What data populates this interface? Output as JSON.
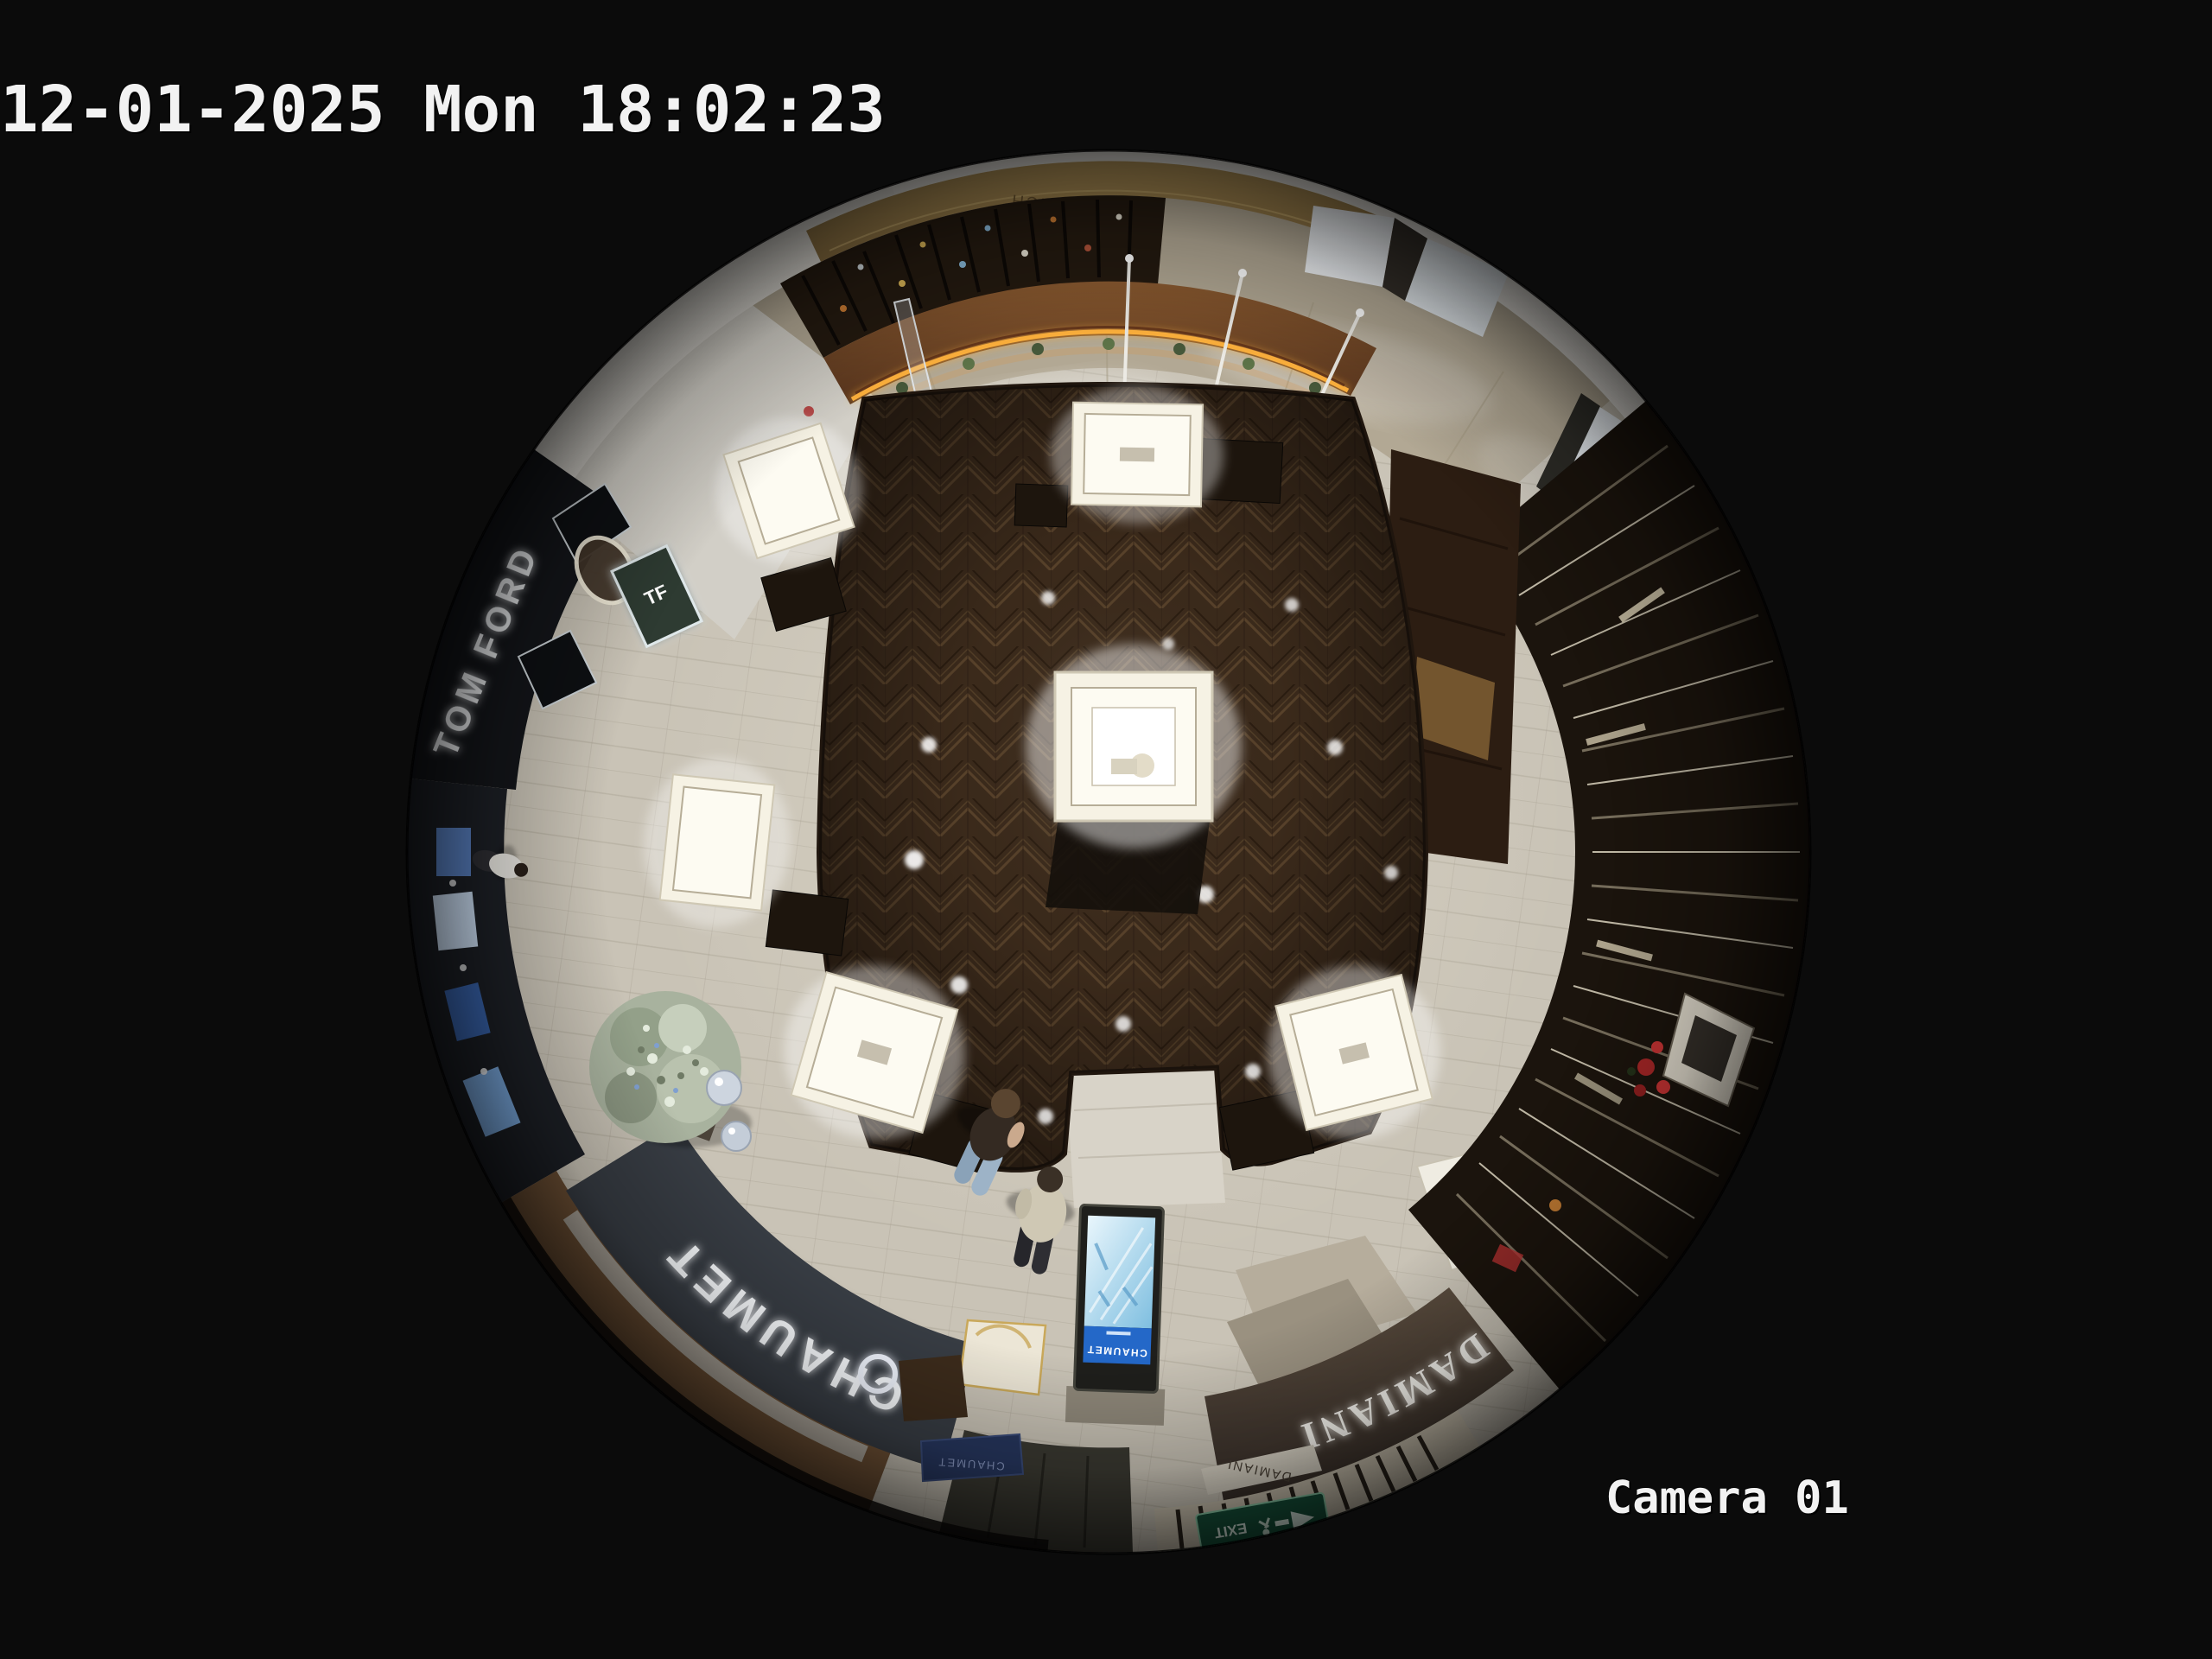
{
  "osd": {
    "timestamp": "12-01-2025 Mon 18:02:23",
    "camera_label": "Camera 01"
  },
  "signs": {
    "tom_ford": "TOM FORD",
    "tf_monogram": "TF",
    "chaumet": "CHAUMET",
    "chaumet_plaque": "CHAUMET",
    "kiosk_brand": "CHAUMET",
    "damiani": "DAMIANI",
    "damiani_small": "DAMIANI",
    "far_wall": "BURCH",
    "exit": "EXIT"
  },
  "colors": {
    "background": "#0b0b0b",
    "osd_text": "#f2f2f2",
    "wood_floor": "#3b2a1b",
    "walkway_tile": "#c9c3b6",
    "marble_corridor": "#b2a894",
    "chaumet_fascia": "#383d44",
    "damiani_fascia": "#4c4136",
    "kiosk_wood": "#7a4a26",
    "led_amber": "#ffb23e",
    "gold_wall": "#9c7f4e",
    "screen_blue": "#bfe3f2",
    "exit_green": "#17543c",
    "tree_silver": "#a8b29e"
  }
}
